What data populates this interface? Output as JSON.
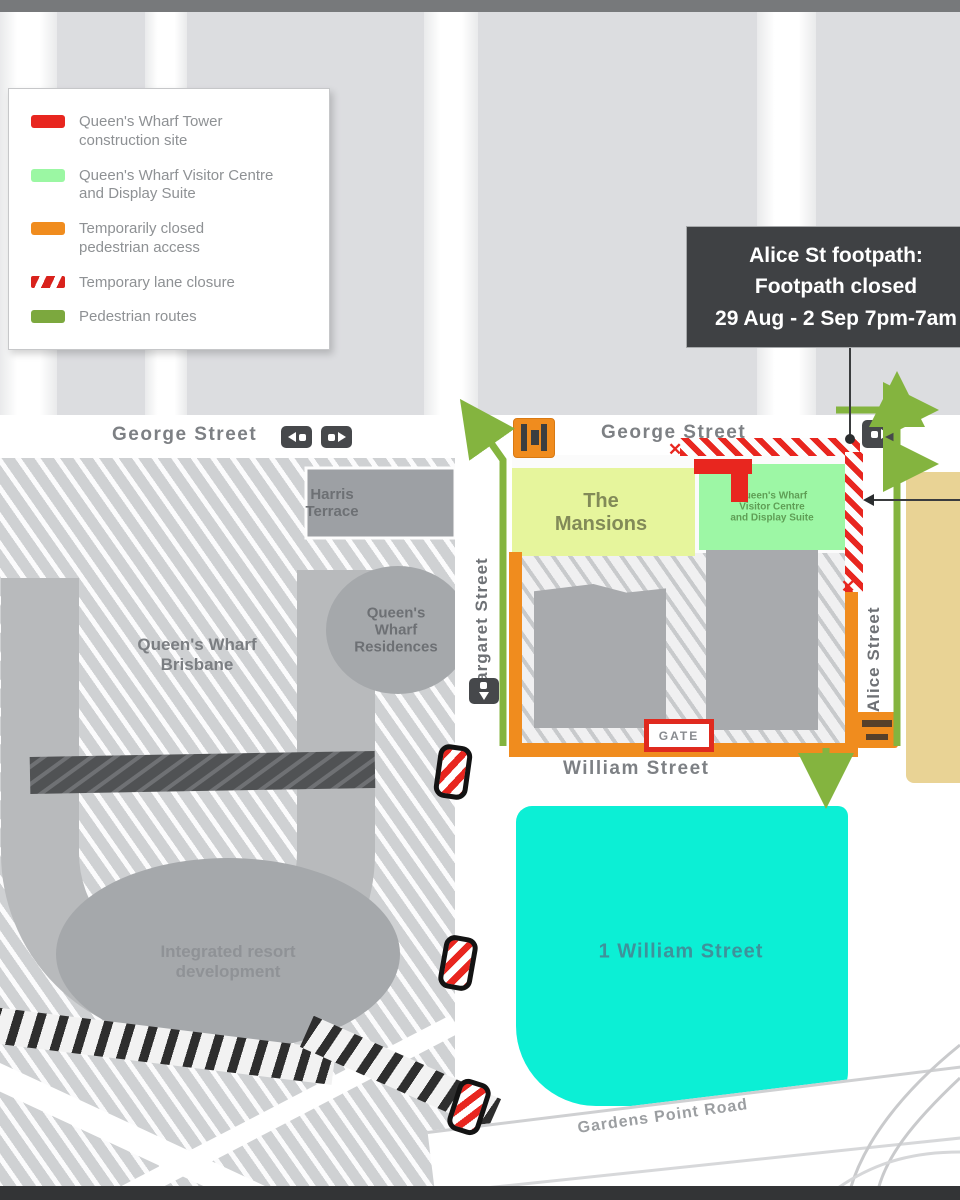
{
  "legend": {
    "items": [
      {
        "label": "Queen's Wharf Tower\nconstruction site"
      },
      {
        "label": "Queen's Wharf Visitor Centre\nand Display Suite"
      },
      {
        "label": "Temporarily closed\npedestrian access"
      },
      {
        "label": "Temporary lane closure"
      },
      {
        "label": "Pedestrian routes"
      }
    ]
  },
  "tooltip": {
    "line1": "Alice St footpath:",
    "line2": "Footpath closed",
    "line3": "29 Aug - 2 Sep 7pm-7am"
  },
  "streets": {
    "george_west": "George Street",
    "george_east": "George Street",
    "margaret": "Margaret Street",
    "alice": "Alice Street",
    "william": "William Street",
    "gardens_point": "Gardens Point Road"
  },
  "sites": {
    "harris_terrace": "Harris\nTerrace",
    "qw_brisbane": "Queen's Wharf\nBrisbane",
    "qw_residences": "Queen's\nWharf\nResidences",
    "integrated_resort": "Integrated resort\ndevelopment",
    "mansions": "The\nMansions",
    "visitor_centre": "Queen's Wharf\nVisitor Centre\nand Display Suite",
    "one_william": "1 William Street",
    "gate": "GATE"
  },
  "icons": {
    "closure_x": "✕"
  },
  "colors": {
    "construction_red": "#e8261f",
    "visitor_green": "#9bf7a3",
    "closed_orange": "#f08c1e",
    "route_olive": "#84b43f",
    "cyan_building": "#0cefd5",
    "tan_building": "#e9d395",
    "tooltip_dark": "#3f4144"
  }
}
